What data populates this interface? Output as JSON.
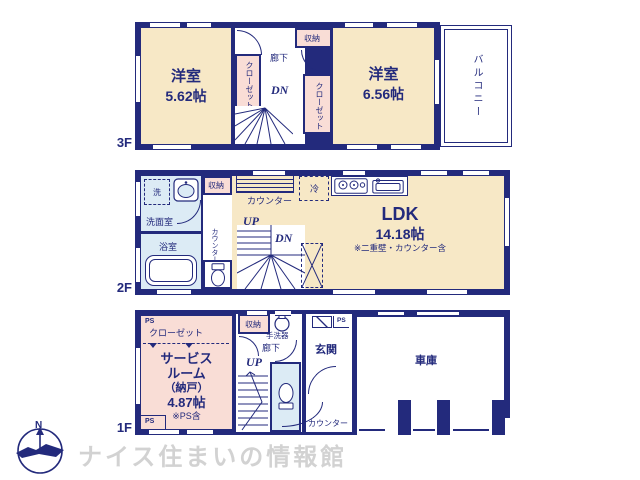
{
  "colors": {
    "wall_navy": "#232a7c",
    "room_cream": "#f7e8c6",
    "room_pink": "#f9ddd6",
    "room_blue": "#dcebf5",
    "logo_gray": "#d2d2d2"
  },
  "floor3": {
    "label": "3F",
    "west_room": {
      "name": "洋室",
      "size": "5.62帖"
    },
    "east_room": {
      "name": "洋室",
      "size": "6.56帖"
    },
    "west_closet": "クローゼット",
    "east_closet": "クローゼット",
    "storage": "収納",
    "hallway": "廊下",
    "dn": "DN",
    "balcony": "バルコニー"
  },
  "floor2": {
    "label": "2F",
    "washroom": "洗面室",
    "washer": "洗",
    "bathroom": "浴室",
    "storage": "収納",
    "counter_top": "カウンター",
    "counter_side": "カウンター",
    "fridge": "冷",
    "up": "UP",
    "dn": "DN",
    "ldk": {
      "name": "LDK",
      "size": "14.18帖",
      "note": "※二重壁・カウンター含"
    }
  },
  "floor1": {
    "label": "1F",
    "ps_top": "PS",
    "ps_bottom": "PS",
    "ps_entry": "PS",
    "closet": "クローゼット",
    "service_room": {
      "line1": "サービス",
      "line2": "ルーム",
      "line3": "（納戸）",
      "size": "4.87帖",
      "note": "※PS含"
    },
    "storage": "収納",
    "hand_basin": "手洗器",
    "hallway": "廊下",
    "up": "UP",
    "entrance": "玄関",
    "counter": "カウンター",
    "garage": "車庫"
  },
  "footer": {
    "compass_n": "N",
    "company": "ナイス住まいの情報館"
  }
}
